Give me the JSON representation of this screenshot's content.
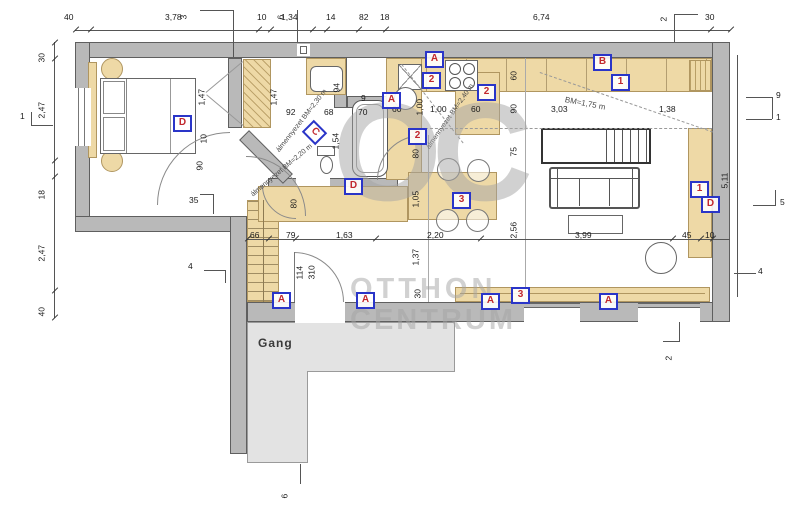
{
  "watermark": {
    "logo": "OC",
    "line1": "OTTHON",
    "line2": "CENTRUM"
  },
  "rooms": {
    "gang": "Gang"
  },
  "markers": {
    "list": [
      "D",
      "C",
      "D",
      "A",
      "A",
      "2",
      "2",
      "2",
      "B",
      "1",
      "3",
      "1",
      "D",
      "A",
      "A",
      "A",
      "3",
      "A"
    ]
  },
  "ceiling": {
    "bath": "álmennyezet BM=2,30 m",
    "hall": "álmennyezet BM=2,20 m",
    "kitchen": "álmennyezet BM=2,40 m",
    "living": "BM=1,75 m"
  },
  "dims": {
    "top": [
      "40",
      "3,78",
      "10",
      "1,34",
      "14",
      "82",
      "18",
      "6,74",
      "30"
    ],
    "top_callouts": [
      "3",
      "6",
      "2"
    ],
    "left": [
      "30",
      "2,47",
      "18",
      "2,47",
      "40"
    ],
    "left_callouts": [
      "1",
      "4"
    ],
    "right": [
      "9",
      "1",
      "5,11",
      "5",
      "4"
    ],
    "bottom_callouts": [
      "2",
      "6"
    ],
    "bedroom": [
      "1,47",
      "10",
      "90",
      "35",
      "1,47"
    ],
    "bath": [
      "92",
      "68",
      "70",
      "9",
      "94",
      "1,54",
      "80"
    ],
    "kitchen": [
      "60",
      "1,00",
      "1,00",
      "60",
      "60",
      "90",
      "3,03",
      "1,38",
      "75",
      "80",
      "1,05",
      "2,56"
    ],
    "mid": [
      "66",
      "79",
      "1,63",
      "2,20",
      "3,99",
      "45",
      "10"
    ],
    "door": [
      "114",
      "310"
    ],
    "window": [
      "1,37",
      "30"
    ]
  },
  "colors": {
    "wall": "#b9b9b9",
    "furniture": "#eed9a6",
    "corridor": "#e3e3e3",
    "marker_border": "#2a35c8",
    "marker_text": "#c1272d"
  }
}
